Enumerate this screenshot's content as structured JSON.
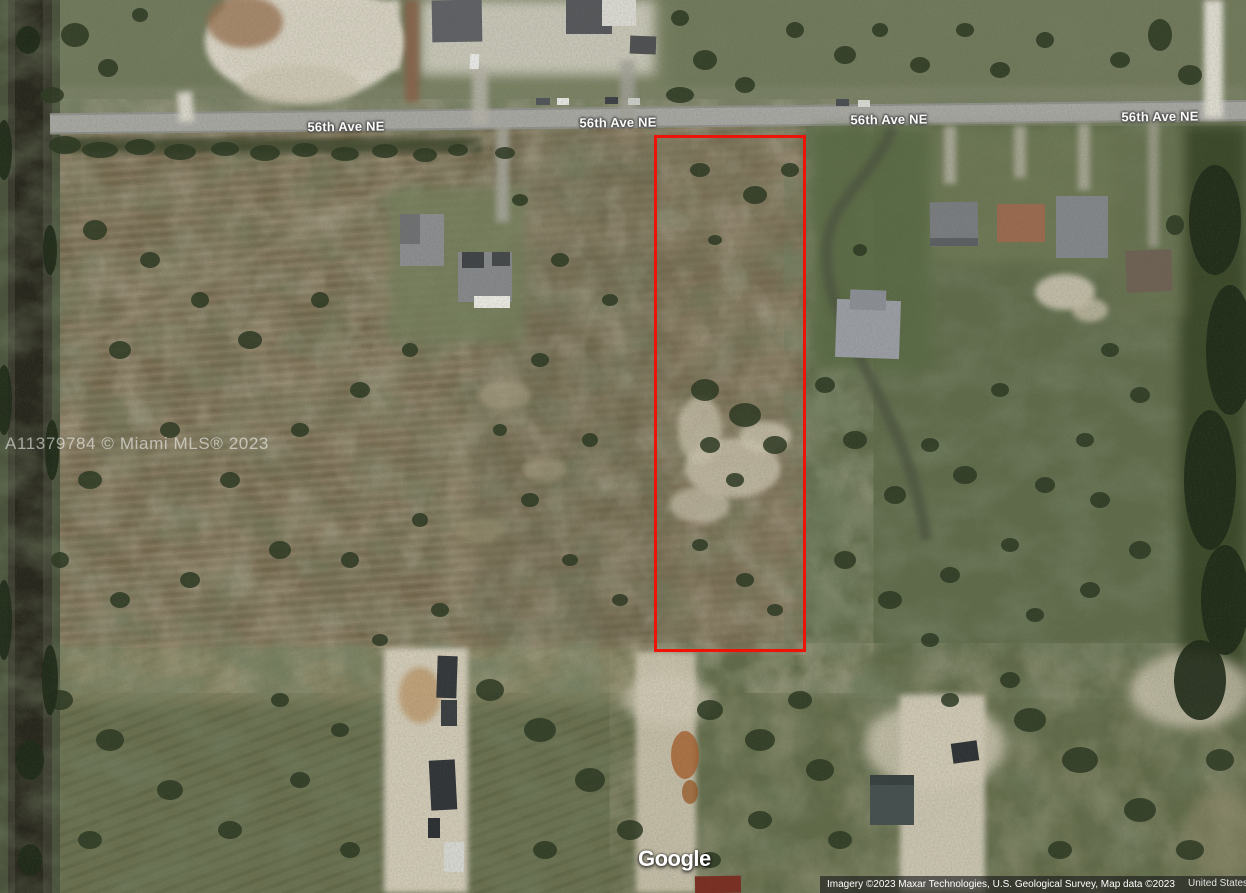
{
  "streets": {
    "avenue_label": "56th Ave NE"
  },
  "mls_watermark": {
    "text": "A11379784 © Miami MLS® 2023"
  },
  "google_logo": {
    "text": "Google"
  },
  "attribution": {
    "credits": "Imagery ©2023 Maxar Technologies, U.S. Geological Survey, Map data ©2023",
    "country": "United States"
  },
  "parcel_overlay": {
    "outline_color": "#ee1306"
  }
}
